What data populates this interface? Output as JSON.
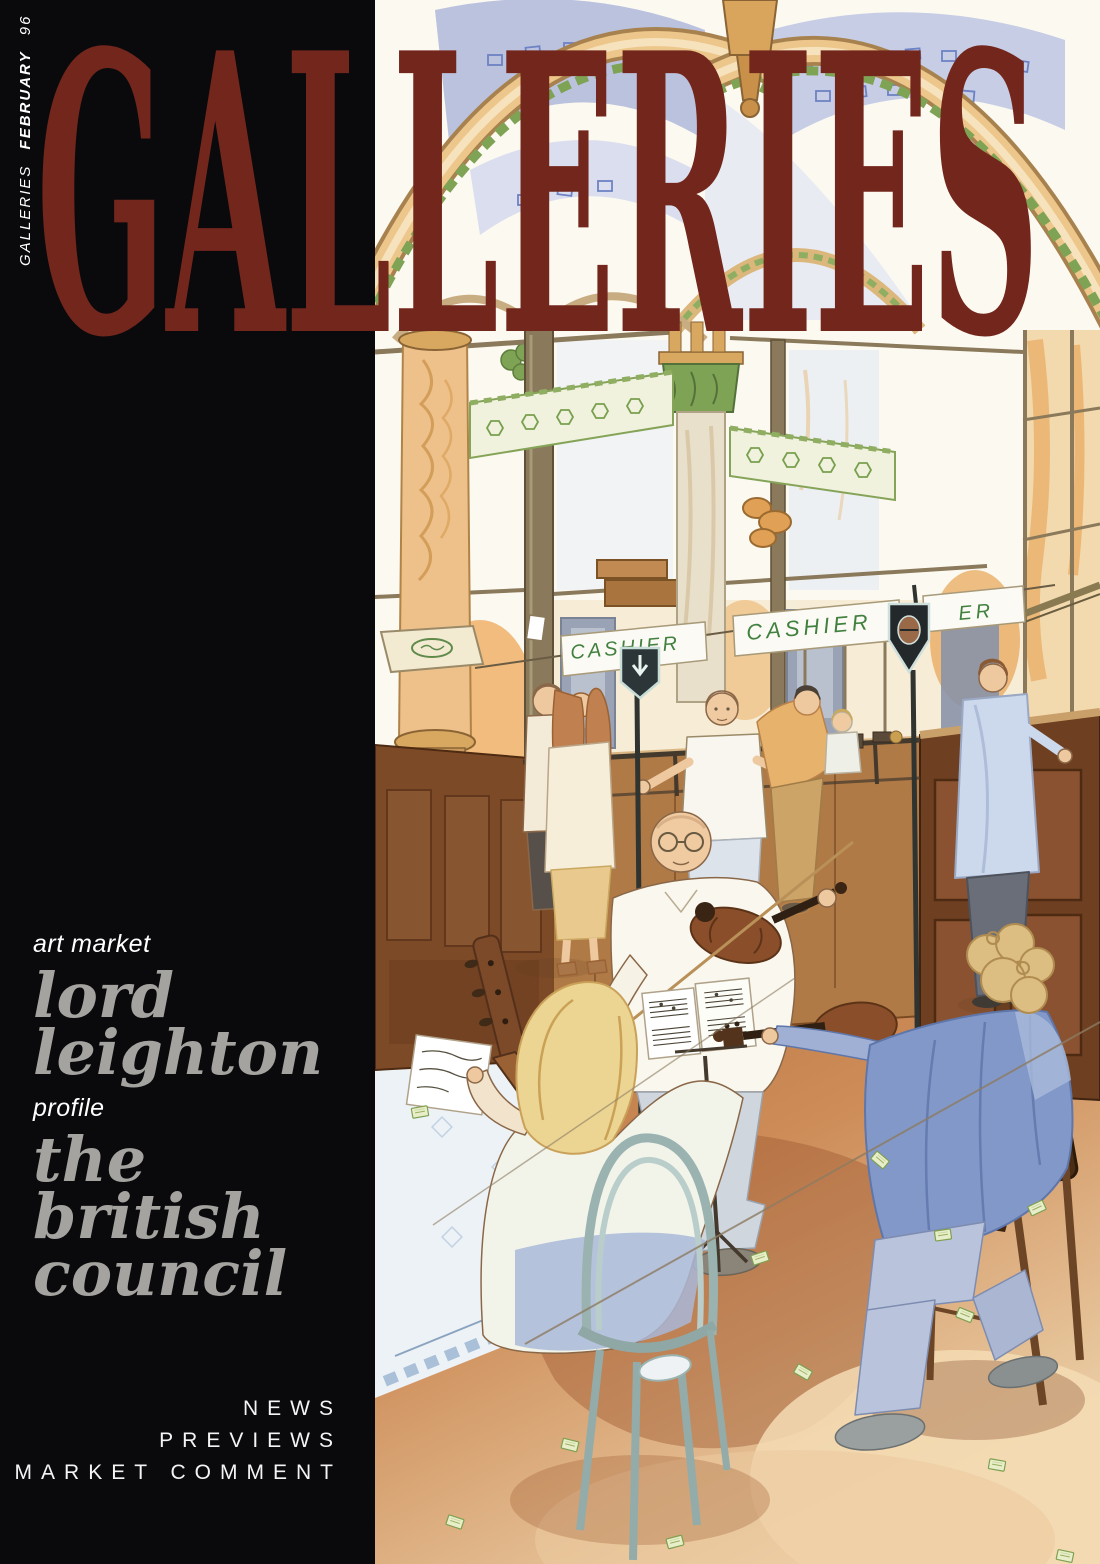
{
  "masthead": {
    "title": "GALLERIES"
  },
  "spine": {
    "magazine": "GALLERIES",
    "month": "FEBRUARY",
    "year": "96"
  },
  "features": [
    {
      "kicker": "art market",
      "lines": [
        "lord",
        "leighton"
      ]
    },
    {
      "kicker": "profile",
      "lines": [
        "the",
        "british",
        "council"
      ]
    }
  ],
  "footer": {
    "lines": [
      "NEWS",
      "PREVIEWS",
      "MARKET COMMENT"
    ]
  },
  "illustration": {
    "signs": {
      "cashier_left": "CASHIER",
      "cashier_center": "CASHIER",
      "cashier_partial": "ER"
    }
  },
  "colors": {
    "panel_black": "#0a0a0d",
    "masthead_red": "#73261c",
    "headline_gray": "#a5a3a0",
    "text_white": "#ffffff",
    "cashier_green": "#41803f"
  }
}
